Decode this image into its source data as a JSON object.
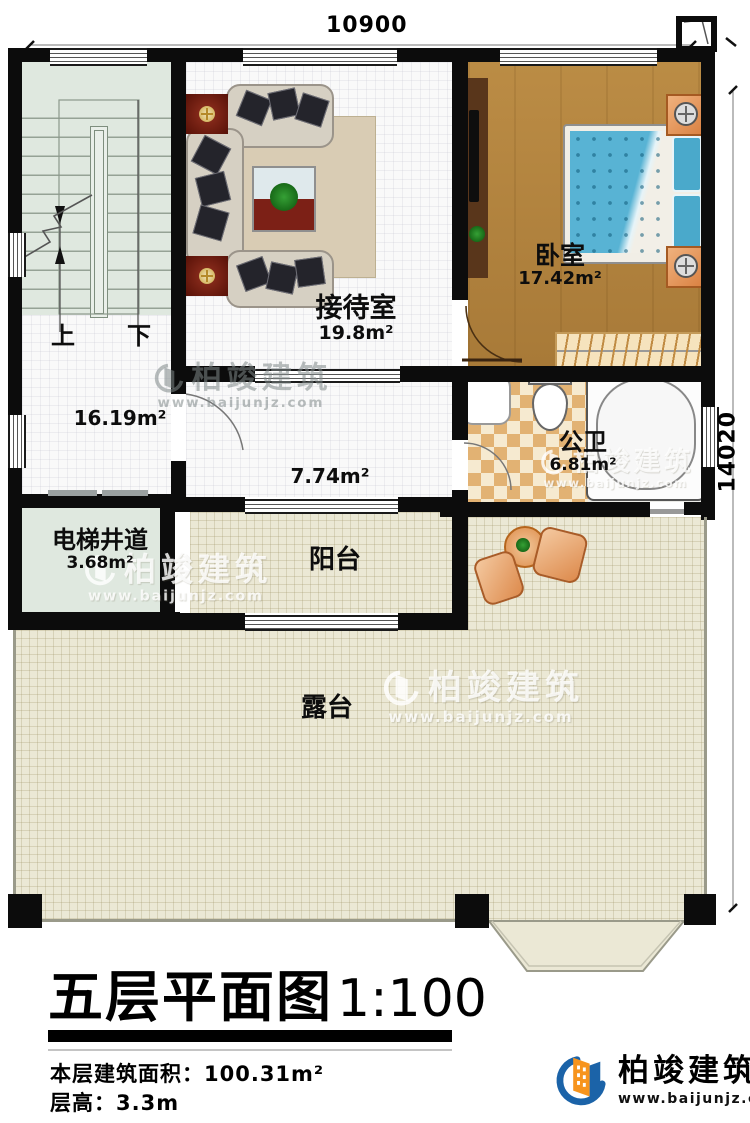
{
  "dimensions": {
    "top": "10900",
    "right": "14020"
  },
  "rooms": {
    "reception": {
      "name": "接待室",
      "area": "19.8m²"
    },
    "bedroom": {
      "name": "卧室",
      "area": "17.42m²"
    },
    "hall": {
      "area": "16.19m²"
    },
    "corridor": {
      "area": "7.74m²"
    },
    "bathroom": {
      "name": "公卫",
      "area": "6.81m²"
    },
    "elevator_shaft": {
      "name": "电梯井道",
      "area": "3.68m²"
    },
    "balcony": {
      "name": "阳台"
    },
    "terrace": {
      "name": "露台"
    }
  },
  "stairs": {
    "up_label": "上",
    "down_label": "下"
  },
  "title_block": {
    "title": "五层平面图",
    "scale": "1:100",
    "area_label": "本层建筑面积：",
    "area_value": "100.31m²",
    "height_label": "层高：",
    "height_value": "3.3m"
  },
  "brand": {
    "name": "柏竣建筑",
    "website": "www.baijunjz.com"
  },
  "colors": {
    "brand_blue": "#1b63a8",
    "brand_orange": "#f7941d",
    "wall_black": "#0c0c0c"
  }
}
